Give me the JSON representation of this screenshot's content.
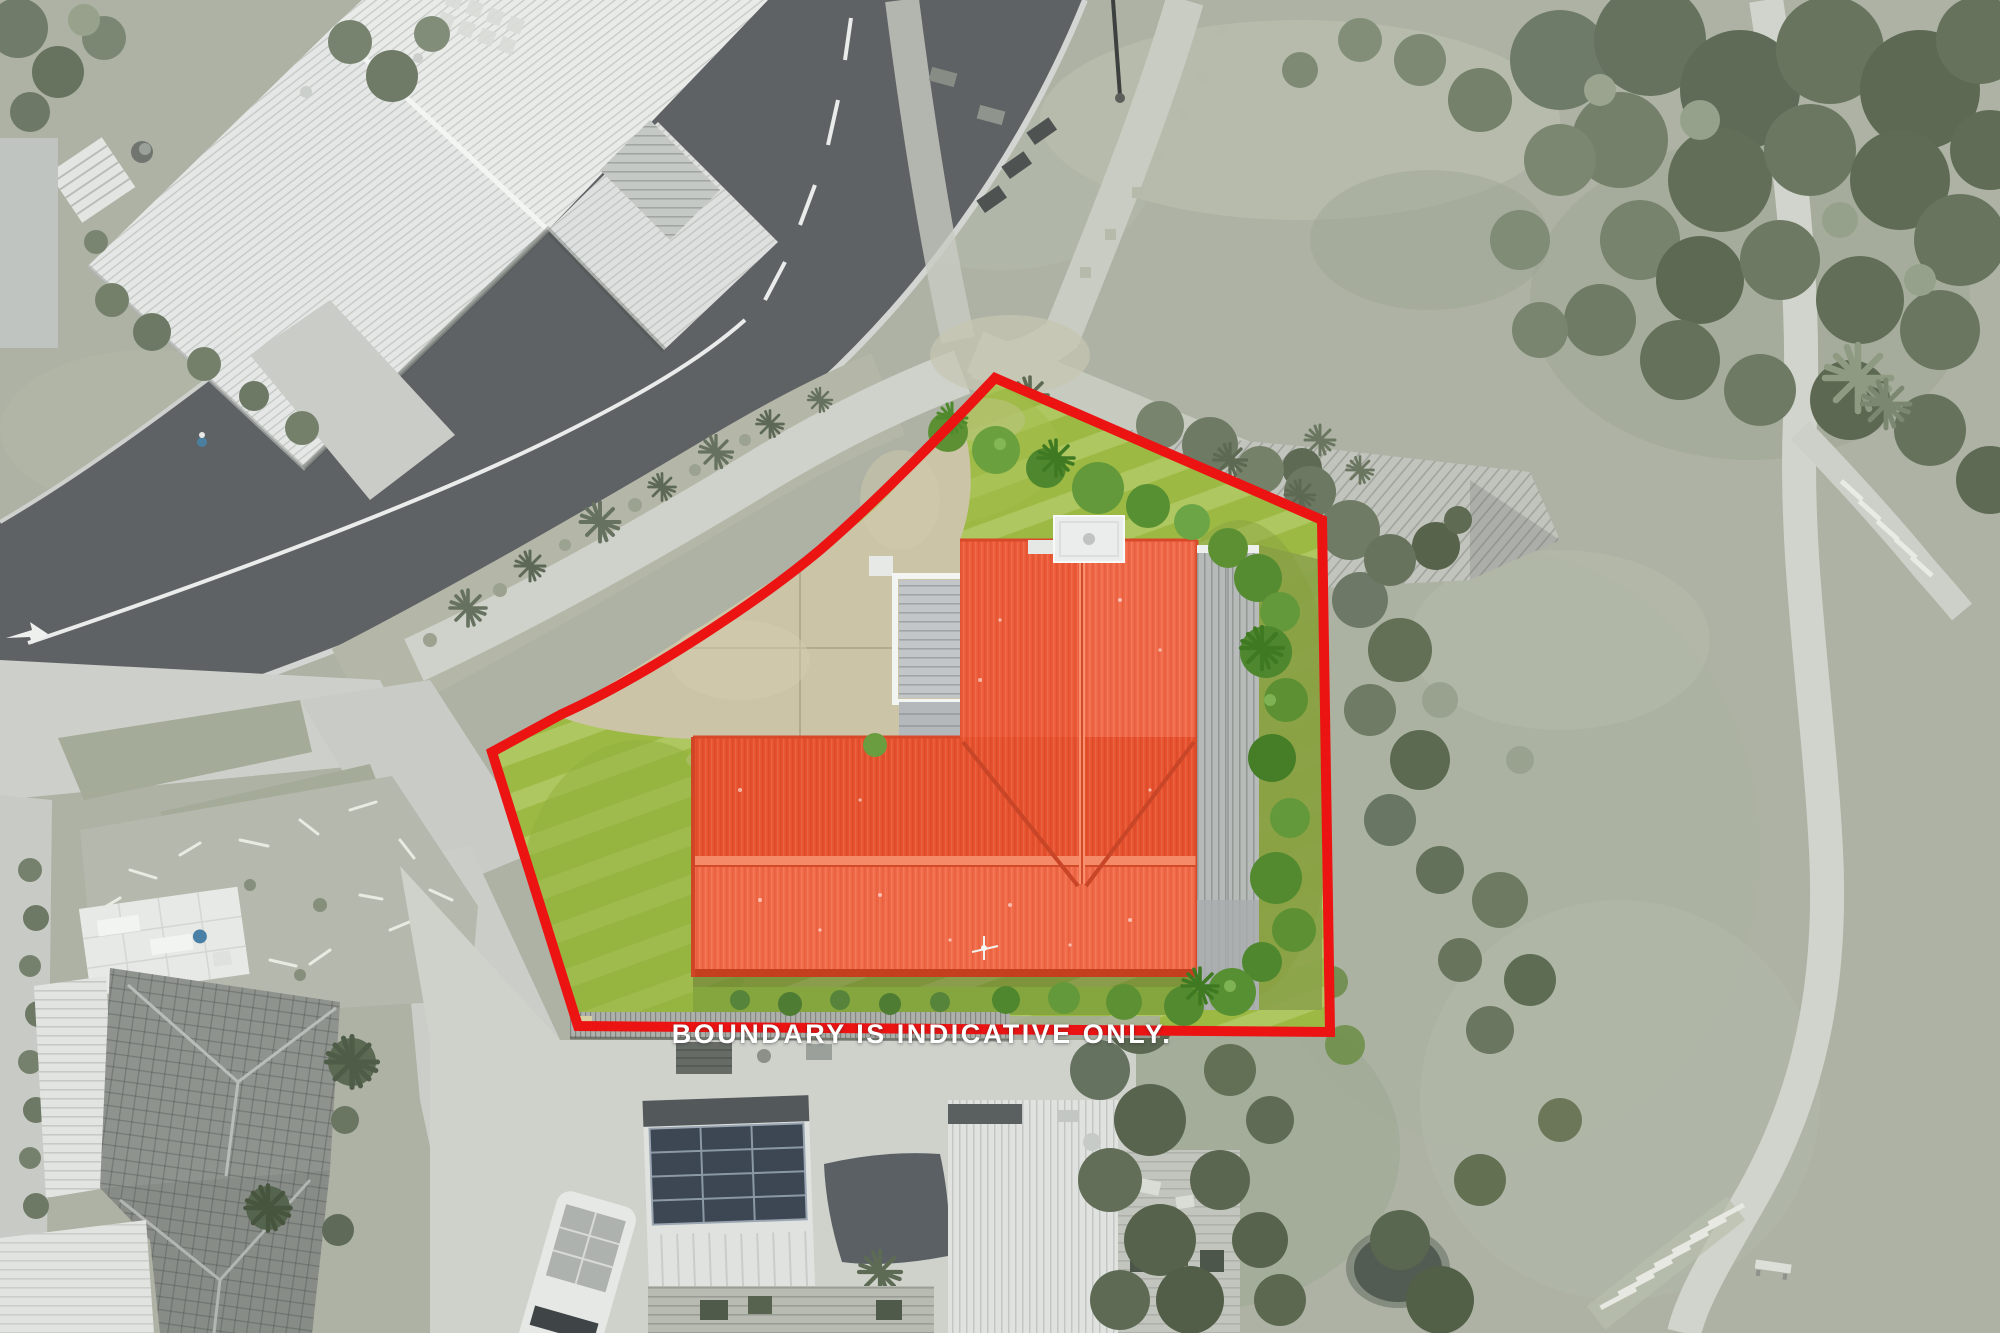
{
  "overlay": {
    "disclaimer": "BOUNDARY IS INDICATIVE ONLY."
  },
  "boundary": {
    "type": "property-boundary-outline",
    "stroke_width_px": 10
  },
  "colors": {
    "boundary_red": "#ec1313",
    "disclaimer_text": "#ffffff",
    "roof_orange": "#ef5f3b",
    "roof_ridge_light": "#f58a69",
    "lawn_green": "#9cb944",
    "bush_green": "#5c9033",
    "driveway_beige": "#ccc4a7",
    "road_asphalt": "#5e6265",
    "path_concrete": "#cdd1c9",
    "surroundings_sage": "#adb2a4",
    "trees_desaturated": "#6a7565",
    "deck_gray": "#b6bab8",
    "solar_panel": "#3d4753"
  }
}
